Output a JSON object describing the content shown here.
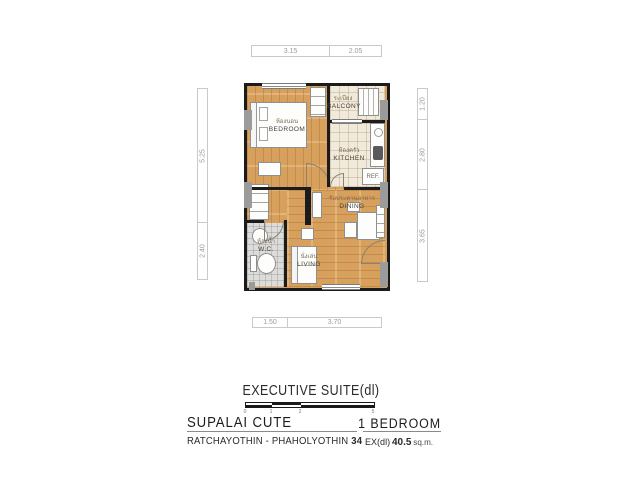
{
  "colors": {
    "wall": "#1b1b1b",
    "wood_floor": "#d7a05c",
    "tile_floor": "#f1e9d9",
    "wc_floor": "#dcdcda",
    "column_gray": "#9b9b9b",
    "dimension_text": "#9a9a9a",
    "footer_text": "#1c1c1c"
  },
  "plan": {
    "rooms": [
      {
        "thai": "ห้องนอน",
        "en": "BEDROOM"
      },
      {
        "thai": "ระเบียง",
        "en": "BALCONY"
      },
      {
        "thai": "ห้องครัว",
        "en": "KITCHEN"
      },
      {
        "thai": "ห้องน้ำ",
        "en": "W.C."
      },
      {
        "thai": "รับประทานอาหาร",
        "en": "DINING"
      },
      {
        "thai": "นั่งเล่น",
        "en": "LIVING"
      }
    ],
    "fixtures": {
      "refrigerator_label": "REF."
    },
    "dimensions": {
      "top": [
        "3.15",
        "2.05"
      ],
      "left": [
        "5.25",
        "2.40"
      ],
      "right": [
        "1.20",
        "2.80",
        "3.65"
      ],
      "bottom": [
        "1.50",
        "3.70"
      ]
    },
    "scale_bar": {
      "ticks": [
        "0",
        "1",
        "2",
        "5"
      ]
    }
  },
  "footer": {
    "unit_type": "EXECUTIVE SUITE(dl)",
    "project_name": "SUPALAI CUTE",
    "bedroom_count": "1 BEDROOM",
    "location": "RATCHAYOTHIN - PHAHOLYOTHIN",
    "location_number": "34",
    "area_code": "EX(dl)",
    "area_value": "40.5",
    "area_unit": "sq.m."
  }
}
